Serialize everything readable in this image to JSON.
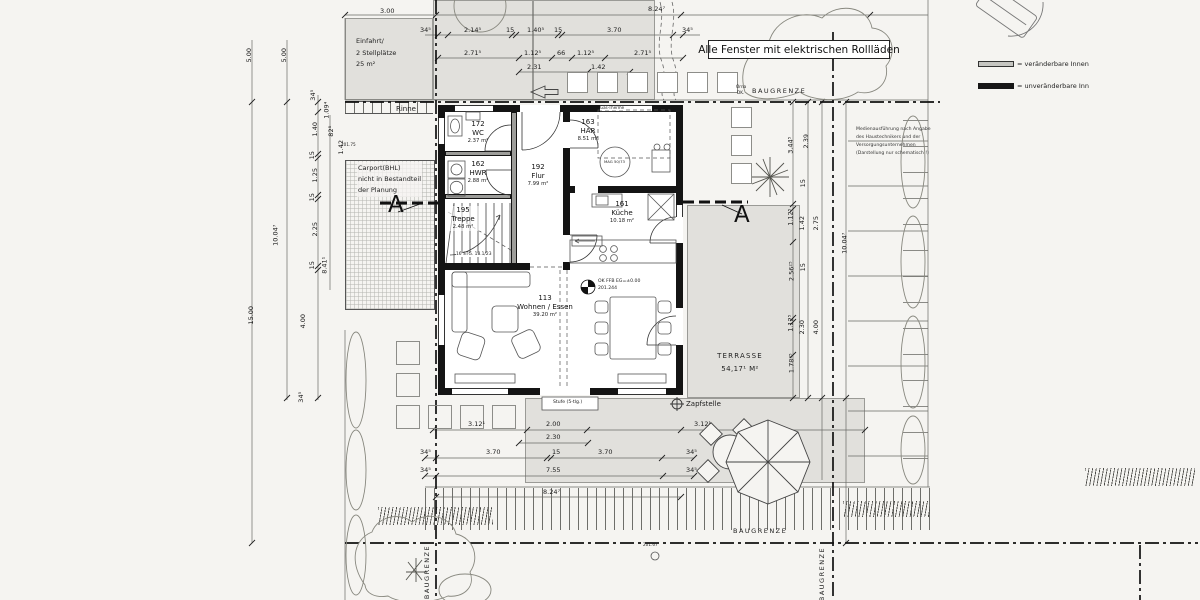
{
  "banner": "Alle Fenster mit elektrischen Rollläden",
  "legend": {
    "variable": "= veränderbare Innen",
    "fixed": "= unveränderbare Inn"
  },
  "site": {
    "baugrenze": "BAUGRENZE",
    "einfahrt1": "Einfahrt/",
    "einfahrt2": "2 Stellplätze",
    "einfahrt3": "25 m²",
    "rinne": "Rinne",
    "carport1": "Carport(BHL)",
    "carport2": "nicht in Bestandteil",
    "carport3": "der Planung",
    "terrasse1": "TERRASSE",
    "terrasse2": "54,17¹ M²",
    "zapfstelle": "Zapfstelle",
    "stufe": "Stufe (5-tlg.)",
    "section": "A",
    "orna1": "Orna",
    "orna2": "DK.",
    "level1": "201.75",
    "level2": "201.67",
    "media1": "Medienausführung nach Angabe",
    "media2": "des Haustechnikers und der",
    "media3": "Versorgungsunternehmen",
    "media4": "(Darstellung nur schematisch !)"
  },
  "rooms": {
    "wc_no": "172",
    "wc_name": "WC",
    "wc_area": "2.37 m²",
    "hwr_no": "162",
    "hwr_name": "HWR",
    "hwr_area": "2.88 m²",
    "tr_no": "195",
    "tr_name": "Treppe",
    "tr_area": "2.48 m²",
    "tr_stg": "16 STG. 18.1/23",
    "fl_no": "192",
    "fl_name": "Flur",
    "fl_area": "7.99 m²",
    "har_no": "163",
    "har_name": "HAR",
    "har_area": "8.51 m²",
    "ku_no": "161",
    "ku_name": "Küche",
    "ku_area": "10.18 m²",
    "wo_no": "113",
    "wo_name": "Wohnen / Essen",
    "wo_area": "39.20 m²",
    "ffb1": "OK FFB EG=±0.00",
    "ffb2": "201.244",
    "mag": "MAG 50/73",
    "therme": "Gas-Therme"
  },
  "dims": {
    "t0": [
      "3.00",
      "8.24⁷"
    ],
    "t1": [
      "34⁵",
      "2.14⁵",
      "15",
      "1.40⁵",
      "15",
      "3.70",
      "34⁵"
    ],
    "t2": [
      "2.71⁵",
      "1.12⁵",
      "66",
      "1.12⁵",
      "2.71⁵"
    ],
    "t3": [
      "2.31",
      "1.42"
    ],
    "l": [
      "5.00",
      "5.00",
      "10.04⁷",
      "15.00",
      "4.00",
      "34⁵",
      "8.41¹"
    ],
    "ls": [
      "34⁵",
      "1.40",
      "15",
      "1.25",
      "15",
      "2.25",
      "15"
    ],
    "lx": [
      "1.09⁴",
      "82⁵",
      "1.42"
    ],
    "r": [
      "3.44⁵",
      "2.39",
      "15",
      "1.12⁵",
      "1.42",
      "2.75",
      "2.56²⁵",
      "15",
      "1.12⁵",
      "2.30",
      "4.00",
      "1.78³⁵",
      "10.04⁷"
    ],
    "b0": [
      "3.12¹",
      "2.00",
      "2.30",
      "3.12¹"
    ],
    "b1": [
      "34⁵",
      "3.70",
      "15",
      "3.70",
      "34⁵"
    ],
    "b2": [
      "34⁵",
      "7.55",
      "34⁵"
    ],
    "b3": [
      "8.24⁷"
    ]
  }
}
